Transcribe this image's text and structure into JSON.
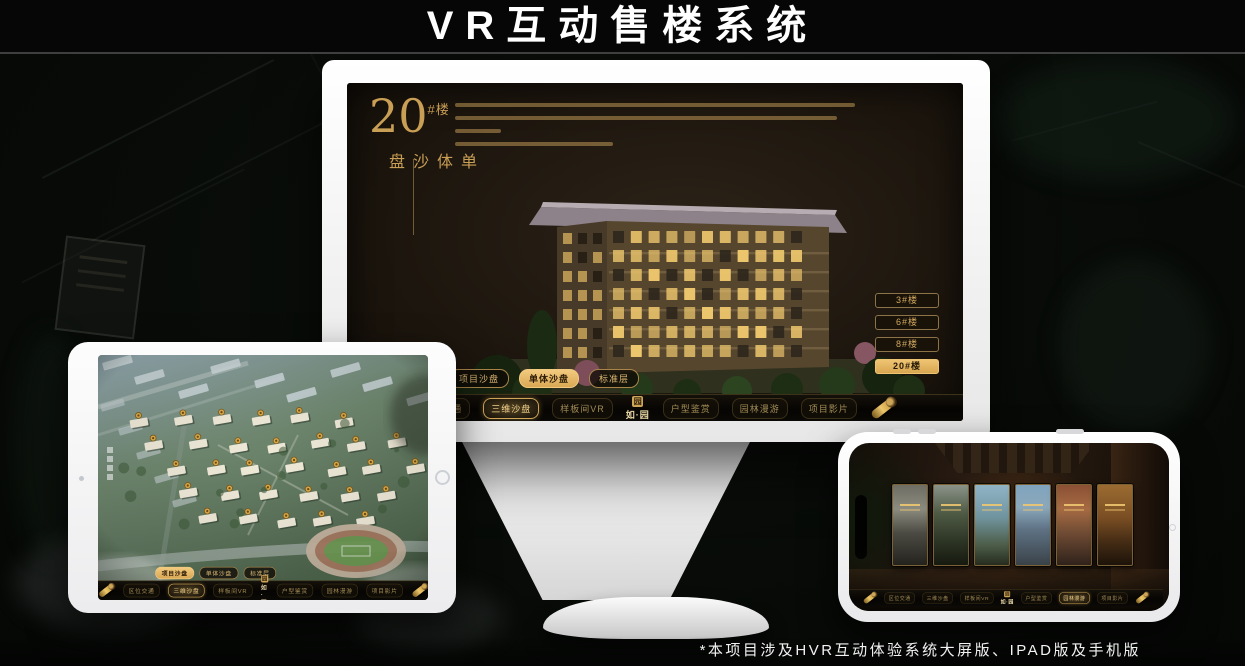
{
  "page": {
    "title": "VR互动售楼系统",
    "footnote": "*本项目涉及HVR互动体验系统大屏版、IPAD版及手机版"
  },
  "brand": {
    "logo_text": "如·园",
    "seal_glyph": "园"
  },
  "colors": {
    "gold": "#cfa557",
    "gold_active_bg": "#e3b873",
    "screen_bg": "#1d160e",
    "title_text": "#ffffff"
  },
  "monitor": {
    "headline": {
      "number": "20",
      "suffix": "#楼",
      "subtitle": "单体沙盘"
    },
    "floor_buttons": [
      {
        "label": "3#楼",
        "active": false
      },
      {
        "label": "6#楼",
        "active": false
      },
      {
        "label": "8#楼",
        "active": false
      },
      {
        "label": "20#楼",
        "active": true
      }
    ],
    "mode_tabs": [
      {
        "label": "项目沙盘",
        "active": false
      },
      {
        "label": "单体沙盘",
        "active": true
      },
      {
        "label": "标准层",
        "active": false
      }
    ],
    "nav": {
      "items_left": [
        "区位交通",
        "三维沙盘",
        "样板间VR"
      ],
      "items_right": [
        "户型鉴赏",
        "园林漫游",
        "项目影片"
      ],
      "active": "三维沙盘"
    }
  },
  "ipad": {
    "mode_tabs": [
      {
        "label": "项目沙盘",
        "active": true
      },
      {
        "label": "单体沙盘",
        "active": false
      },
      {
        "label": "标准层",
        "active": false
      }
    ],
    "nav": {
      "items_left": [
        "区位交通",
        "三维沙盘",
        "样板间VR"
      ],
      "items_right": [
        "户型鉴赏",
        "园林漫游",
        "项目影片"
      ],
      "active": "三维沙盘"
    }
  },
  "phone": {
    "nav": {
      "items_left": [
        "区位交通",
        "三维沙盘",
        "样板间VR"
      ],
      "items_right": [
        "户型鉴赏",
        "园林漫游",
        "项目影片"
      ],
      "active": "园林漫游"
    },
    "scene_card_count": 6
  }
}
